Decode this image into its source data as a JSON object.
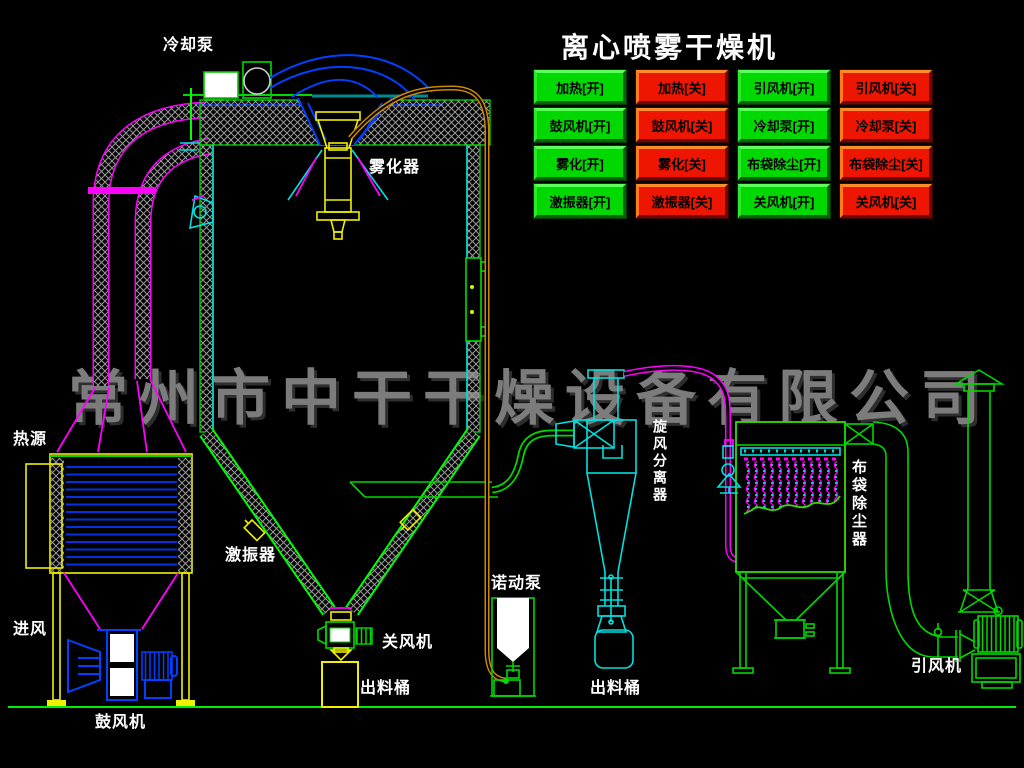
{
  "title": "离心喷雾干燥机",
  "watermark": "常州市中干干燥设备有限公司",
  "colors": {
    "background": "#000000",
    "button_on": "#00d800",
    "button_off": "#ee1600",
    "line_cyan": "#00e0e0",
    "line_green": "#00d800",
    "line_yellow": "#f0f000",
    "line_blue": "#0040ff",
    "line_magenta": "#ff00ff",
    "feed_pipe_orange": "#cc8800",
    "watermark_gray": "#7c7c7c",
    "label_white": "#ffffff"
  },
  "control_panel": {
    "buttons": [
      {
        "id": "heater-on",
        "label": "加热[开]",
        "state": "on"
      },
      {
        "id": "heater-off",
        "label": "加热[关]",
        "state": "off"
      },
      {
        "id": "id-fan-on",
        "label": "引风机[开]",
        "state": "on"
      },
      {
        "id": "id-fan-off",
        "label": "引风机[关]",
        "state": "off"
      },
      {
        "id": "blower-on",
        "label": "鼓风机[开]",
        "state": "on"
      },
      {
        "id": "blower-off",
        "label": "鼓风机[关]",
        "state": "off"
      },
      {
        "id": "cooling-pump-on",
        "label": "冷却泵[开]",
        "state": "on"
      },
      {
        "id": "cooling-pump-off",
        "label": "冷却泵[关]",
        "state": "off"
      },
      {
        "id": "atomizer-on",
        "label": "雾化[开]",
        "state": "on"
      },
      {
        "id": "atomizer-off",
        "label": "雾化[关]",
        "state": "off"
      },
      {
        "id": "bag-filter-on",
        "label": "布袋除尘[开]",
        "state": "on"
      },
      {
        "id": "bag-filter-off",
        "label": "布袋除尘[关]",
        "state": "off"
      },
      {
        "id": "vibrator-on",
        "label": "激振器[开]",
        "state": "on"
      },
      {
        "id": "vibrator-off",
        "label": "激振器[关]",
        "state": "off"
      },
      {
        "id": "rotary-valve-on",
        "label": "关风机[开]",
        "state": "on"
      },
      {
        "id": "rotary-valve-off",
        "label": "关风机[关]",
        "state": "off"
      }
    ]
  },
  "equipment_labels": [
    {
      "id": "cooling-pump",
      "text": "冷却泵"
    },
    {
      "id": "atomizer",
      "text": "雾化器"
    },
    {
      "id": "heat-source",
      "text": "热源"
    },
    {
      "id": "air-inlet",
      "text": "进风"
    },
    {
      "id": "blower",
      "text": "鼓风机"
    },
    {
      "id": "vibrator",
      "text": "激振器"
    },
    {
      "id": "rotary-valve",
      "text": "关风机"
    },
    {
      "id": "discharge-bucket-left",
      "text": "出料桶"
    },
    {
      "id": "peristaltic-pump",
      "text": "诺动泵"
    },
    {
      "id": "discharge-bucket-cyclone",
      "text": "出料桶"
    },
    {
      "id": "cyclone-separator",
      "text": "旋风分离器"
    },
    {
      "id": "bag-filter",
      "text": "布袋除尘器"
    },
    {
      "id": "induced-draft-fan",
      "text": "引风机"
    }
  ]
}
